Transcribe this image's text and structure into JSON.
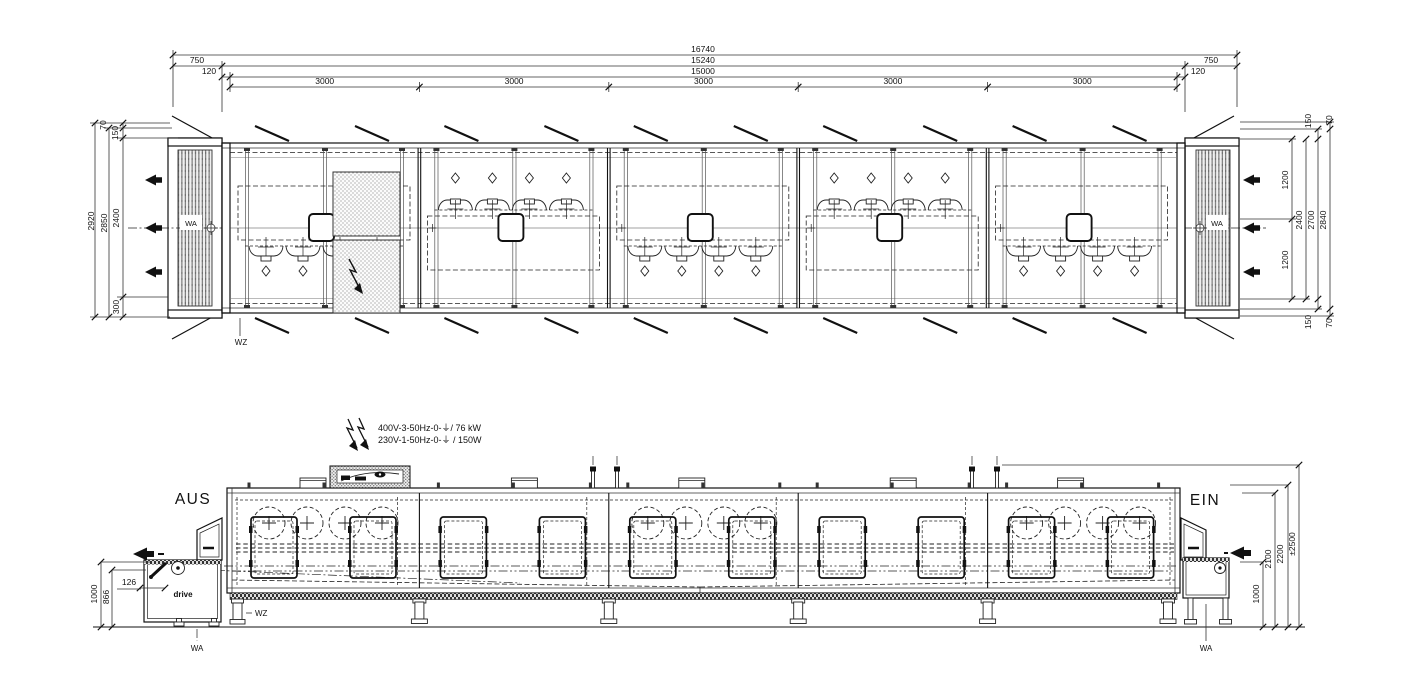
{
  "plan": {
    "dims": {
      "total": "16740",
      "left_750": "750",
      "mid_15240": "15240",
      "right_750": "750",
      "left_120": "120",
      "mid_15000": "15000",
      "right_120": "120",
      "modules": [
        "3000",
        "3000",
        "3000",
        "3000",
        "3000"
      ],
      "left_chain": {
        "d70": "70",
        "d150": "150",
        "d2920": "2920",
        "d2850": "2850",
        "d2400": "2400",
        "d300": "300"
      },
      "right_chain": {
        "top_150": "150",
        "top_70": "70",
        "d1200_top": "1200",
        "d2400": "2400",
        "d2700": "2700",
        "d2840": "2840",
        "d1200_bottom": "1200",
        "bottom_150": "150",
        "bottom_70": "70"
      }
    },
    "labels": {
      "wa_left": "WA",
      "wa_right": "WA",
      "wz": "WZ"
    }
  },
  "elevation": {
    "labels": {
      "exit": "AUS",
      "entry": "EIN",
      "drive": "drive",
      "wz": "WZ",
      "wa_left": "WA",
      "wa_right": "WA"
    },
    "power": {
      "line1": "400V-3-50Hz-0-⏚/ 76 kW",
      "line2": "230V-1-50Hz-0-⏚ / 150W"
    },
    "dims": {
      "d126": "126",
      "d866": "866",
      "d1000_left": "1000",
      "d1000_right": "1000",
      "d2100": "2100",
      "d2200": "2200",
      "d2500": "±2500"
    }
  }
}
